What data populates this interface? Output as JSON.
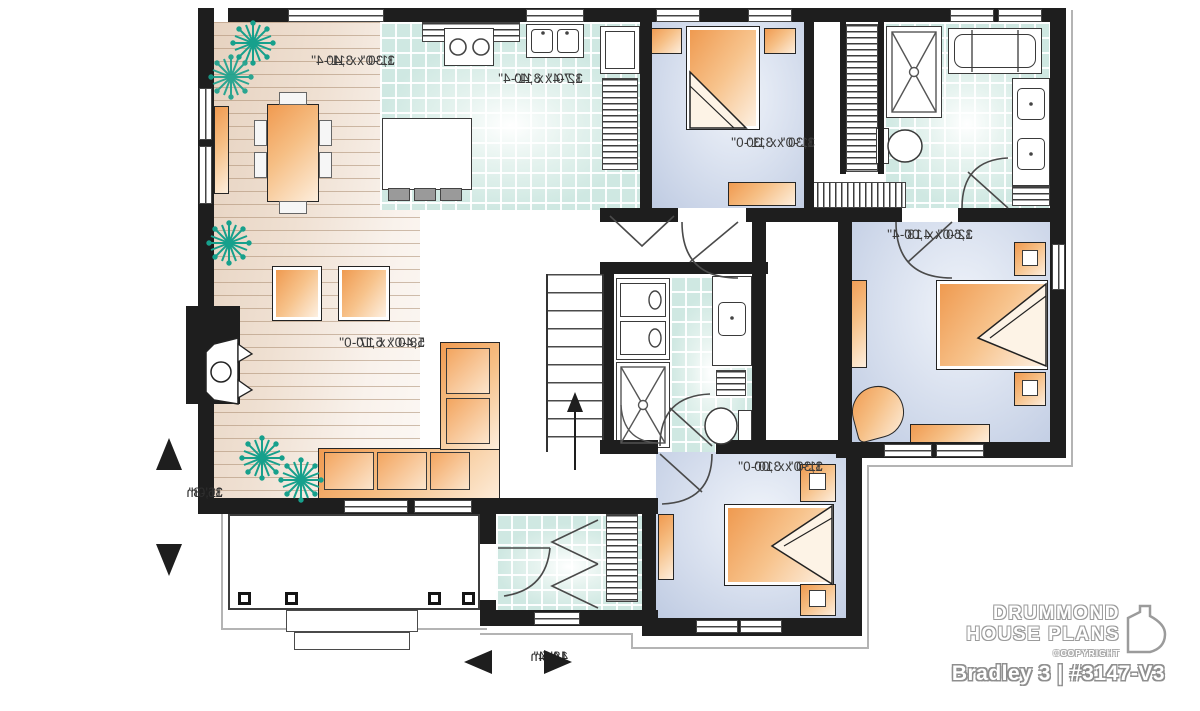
{
  "plan": {
    "rooms": [
      {
        "name": "dining-room",
        "imperial": "11'-0\" x 11'-4\"",
        "metric": "3,30 x 3,40"
      },
      {
        "name": "kitchen",
        "imperial": "12'-4\" x 11'-4\"",
        "metric": "3,70 x 3,40"
      },
      {
        "name": "living-room",
        "imperial": "18'-0\" x 17'-0\"",
        "metric": "5,40 x 5,10"
      },
      {
        "name": "bedroom-2",
        "imperial": "11'-0\" x 11'-0\"",
        "metric": "3,30 x 3,30"
      },
      {
        "name": "master-bedroom",
        "imperial": "12'-0\" x 13'-4\"",
        "metric": "3,60 x 4,00"
      },
      {
        "name": "bedroom-3",
        "imperial": "11'-0\" x 10'-0\"",
        "metric": "3,30 x 3,00"
      }
    ],
    "overall_dimensions": {
      "depth_imperial": "36'-8\"",
      "depth_metric": "11,0m",
      "width_imperial": "48'-4\"",
      "width_metric": "14,5m"
    },
    "text_note": "room dimension labels appear mirrored (reversed floor plan)"
  },
  "branding": {
    "brand_line1": "DRUMMOND",
    "brand_line2": "HOUSE PLANS",
    "copyright": "©COPYRIGHT",
    "plan_name": "Bradley 3 | #3147-V3"
  },
  "colors": {
    "wall": "#1e1e1e",
    "wood_floor": "#ecd9c9",
    "ceramic_tile": "#cfe8e2",
    "bedroom_floor": "#bfcbe2",
    "furniture_accent": "#f09a50",
    "plant": "#17a08c",
    "label_text": "#3b3b3b"
  }
}
